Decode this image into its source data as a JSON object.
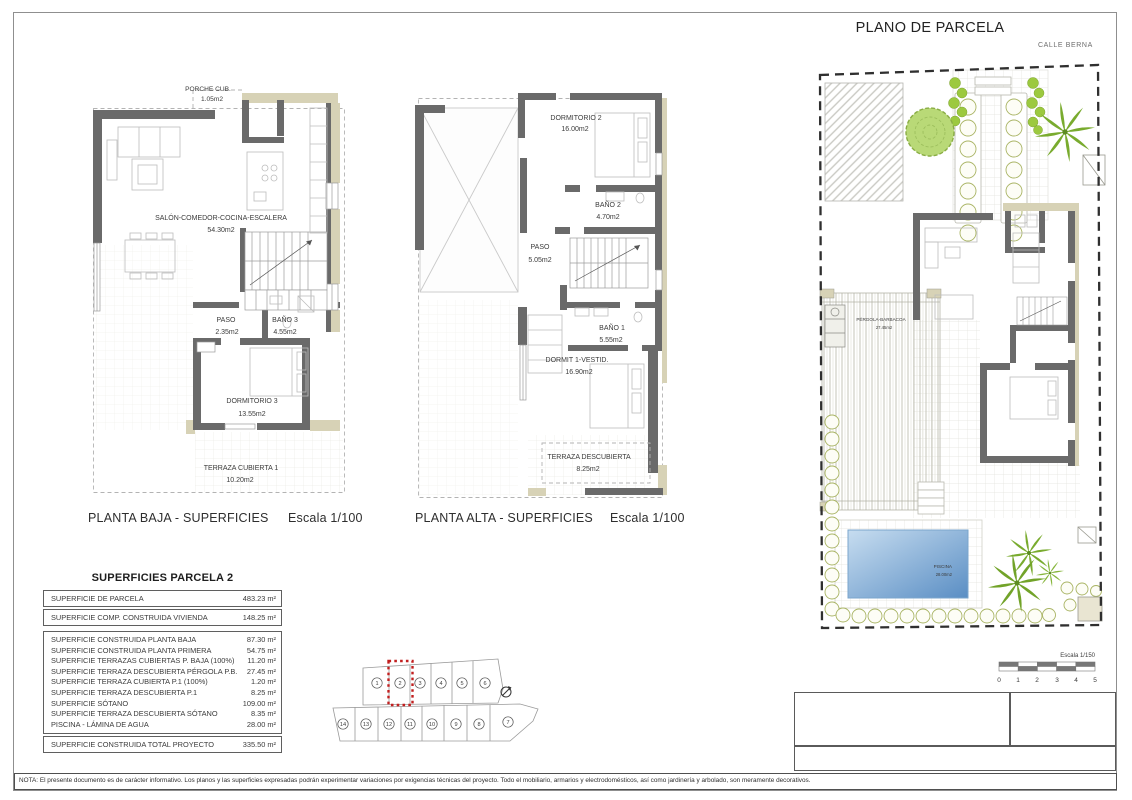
{
  "sheet": {
    "nota": "NOTA: El presente documento es de carácter informativo. Los planos y las superficies expresadas podrán experimentar variaciones por exigencias técnicas del proyecto. Todo el mobiliario, armarios y electrodomésticos, así como jardinería y arbolado, son meramente decorativos."
  },
  "planta_baja": {
    "title": "PLANTA BAJA - SUPERFICIES",
    "escala": "Escala 1/100",
    "rooms": {
      "porche": {
        "name": "PORCHE CUB.",
        "area": "1.05m2"
      },
      "salon": {
        "name": "SALÓN-COMEDOR-COCINA-ESCALERA",
        "area": "54.30m2"
      },
      "paso": {
        "name": "PASO",
        "area": "2.35m2"
      },
      "bano3": {
        "name": "BAÑO 3",
        "area": "4.55m2"
      },
      "dormitorio3": {
        "name": "DORMITORIO 3",
        "area": "13.55m2"
      },
      "terraza_cubierta1": {
        "name": "TERRAZA CUBIERTA 1",
        "area": "10.20m2"
      }
    }
  },
  "planta_alta": {
    "title": "PLANTA ALTA - SUPERFICIES",
    "escala": "Escala 1/100",
    "rooms": {
      "dormitorio2": {
        "name": "DORMITORIO 2",
        "area": "16.00m2"
      },
      "bano2": {
        "name": "BAÑO 2",
        "area": "4.70m2"
      },
      "paso": {
        "name": "PASO",
        "area": "5.05m2"
      },
      "bano1": {
        "name": "BAÑO 1",
        "area": "5.55m2"
      },
      "dormit1_vestid": {
        "name": "DORMIT 1-VESTID.",
        "area": "16.90m2"
      },
      "terraza_descubierta": {
        "name": "TERRAZA DESCUBIERTA",
        "area": "8.25m2"
      }
    }
  },
  "plano_parcela": {
    "title": "PLANO DE PARCELA",
    "calle": "CALLE BERNA",
    "pergola": {
      "name": "PÉRGOLA-BARBACOA",
      "area": "27.45m2"
    },
    "piscina": {
      "name": "PISCINA",
      "area": "28.00m2"
    },
    "escala": "Escala 1/150",
    "scale_ticks": [
      "0",
      "1",
      "2",
      "3",
      "4",
      "5"
    ]
  },
  "superficies": {
    "title": "SUPERFICIES PARCELA 2",
    "parcela_row": {
      "label": "SUPERFICIE DE PARCELA",
      "value": "483.23 m²"
    },
    "vivienda_row": {
      "label": "SUPERFICIE COMP. CONSTRUIDA VIVIENDA",
      "value": "148.25 m²"
    },
    "detail_rows": [
      {
        "label": "SUPERFICIE CONSTRUIDA PLANTA BAJA",
        "value": "87.30 m²"
      },
      {
        "label": "SUPERFICIE CONSTRUIDA PLANTA PRIMERA",
        "value": "54.75 m²"
      },
      {
        "label": "SUPERFICIE TERRAZAS CUBIERTAS P. BAJA (100%)",
        "value": "11.20 m²"
      },
      {
        "label": "SUPERFICIE TERRAZA DESCUBIERTA PÉRGOLA P.B.",
        "value": "27.45 m²"
      },
      {
        "label": "SUPERFICIE TERRAZA CUBIERTA P.1 (100%)",
        "value": "1.20 m²"
      },
      {
        "label": "SUPERFICIE TERRAZA DESCUBIERTA P.1",
        "value": "8.25 m²"
      },
      {
        "label": "SUPERFICIE SÓTANO",
        "value": "109.00 m²"
      },
      {
        "label": "SUPERFICIE TERRAZA DESCUBIERTA SÓTANO",
        "value": "8.35 m²"
      },
      {
        "label": "PISCINA - LÁMINA DE AGUA",
        "value": "28.00 m²"
      }
    ],
    "total_row": {
      "label": "SUPERFICIE CONSTRUIDA TOTAL PROYECTO",
      "value": "335.50 m²"
    }
  },
  "parcel_map": {
    "top_row": [
      "1",
      "2",
      "3",
      "4",
      "5",
      "6"
    ],
    "bottom_row": [
      "14",
      "13",
      "12",
      "11",
      "10",
      "9",
      "8",
      "7"
    ],
    "highlighted_plot": "2"
  },
  "colors": {
    "wall": "#6a6a6a",
    "tan": "#d7d2b6",
    "green": "#8fbe3a",
    "pool_dark": "#5a8ec4",
    "highlight_red": "#c11f1f"
  }
}
